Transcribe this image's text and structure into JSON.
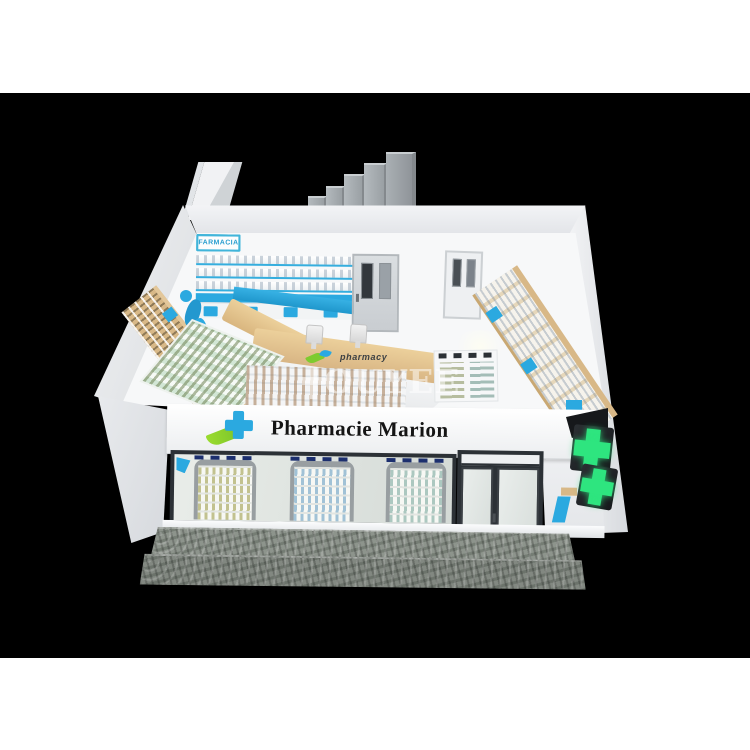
{
  "image": {
    "subject": "3D render of a pharmacy shop interior design, isometric cutaway view on black canvas",
    "background_color": "#000000",
    "page_background": "#ffffff"
  },
  "storefront": {
    "sign_text": "Pharmacie Marion",
    "sign_text_color": "#141414",
    "fascia_color": "#f8fafb",
    "logo_cross_color": "#2BA9E0",
    "logo_leaf_color": "#8CC63F",
    "display_window_count": 3,
    "green_cross_color": "#2EE57F",
    "stone_base_color": "#8D948C",
    "frame_color": "#2C3136"
  },
  "interior": {
    "farmacia_signs": [
      "FARMACIA",
      "FARMACIA",
      "FARMACIA"
    ],
    "farmacia_text_color": "#2B9FD0",
    "accent_blue": "#2BA9E0",
    "wood_color": "#D8B887",
    "wall_color": "#F2F3F5",
    "floor_color": "#F7F8F9",
    "door_count": 2,
    "checkout_monitor_count": 2
  },
  "watermark": {
    "brand": "OUYEE",
    "tagline": "pharmacy"
  }
}
